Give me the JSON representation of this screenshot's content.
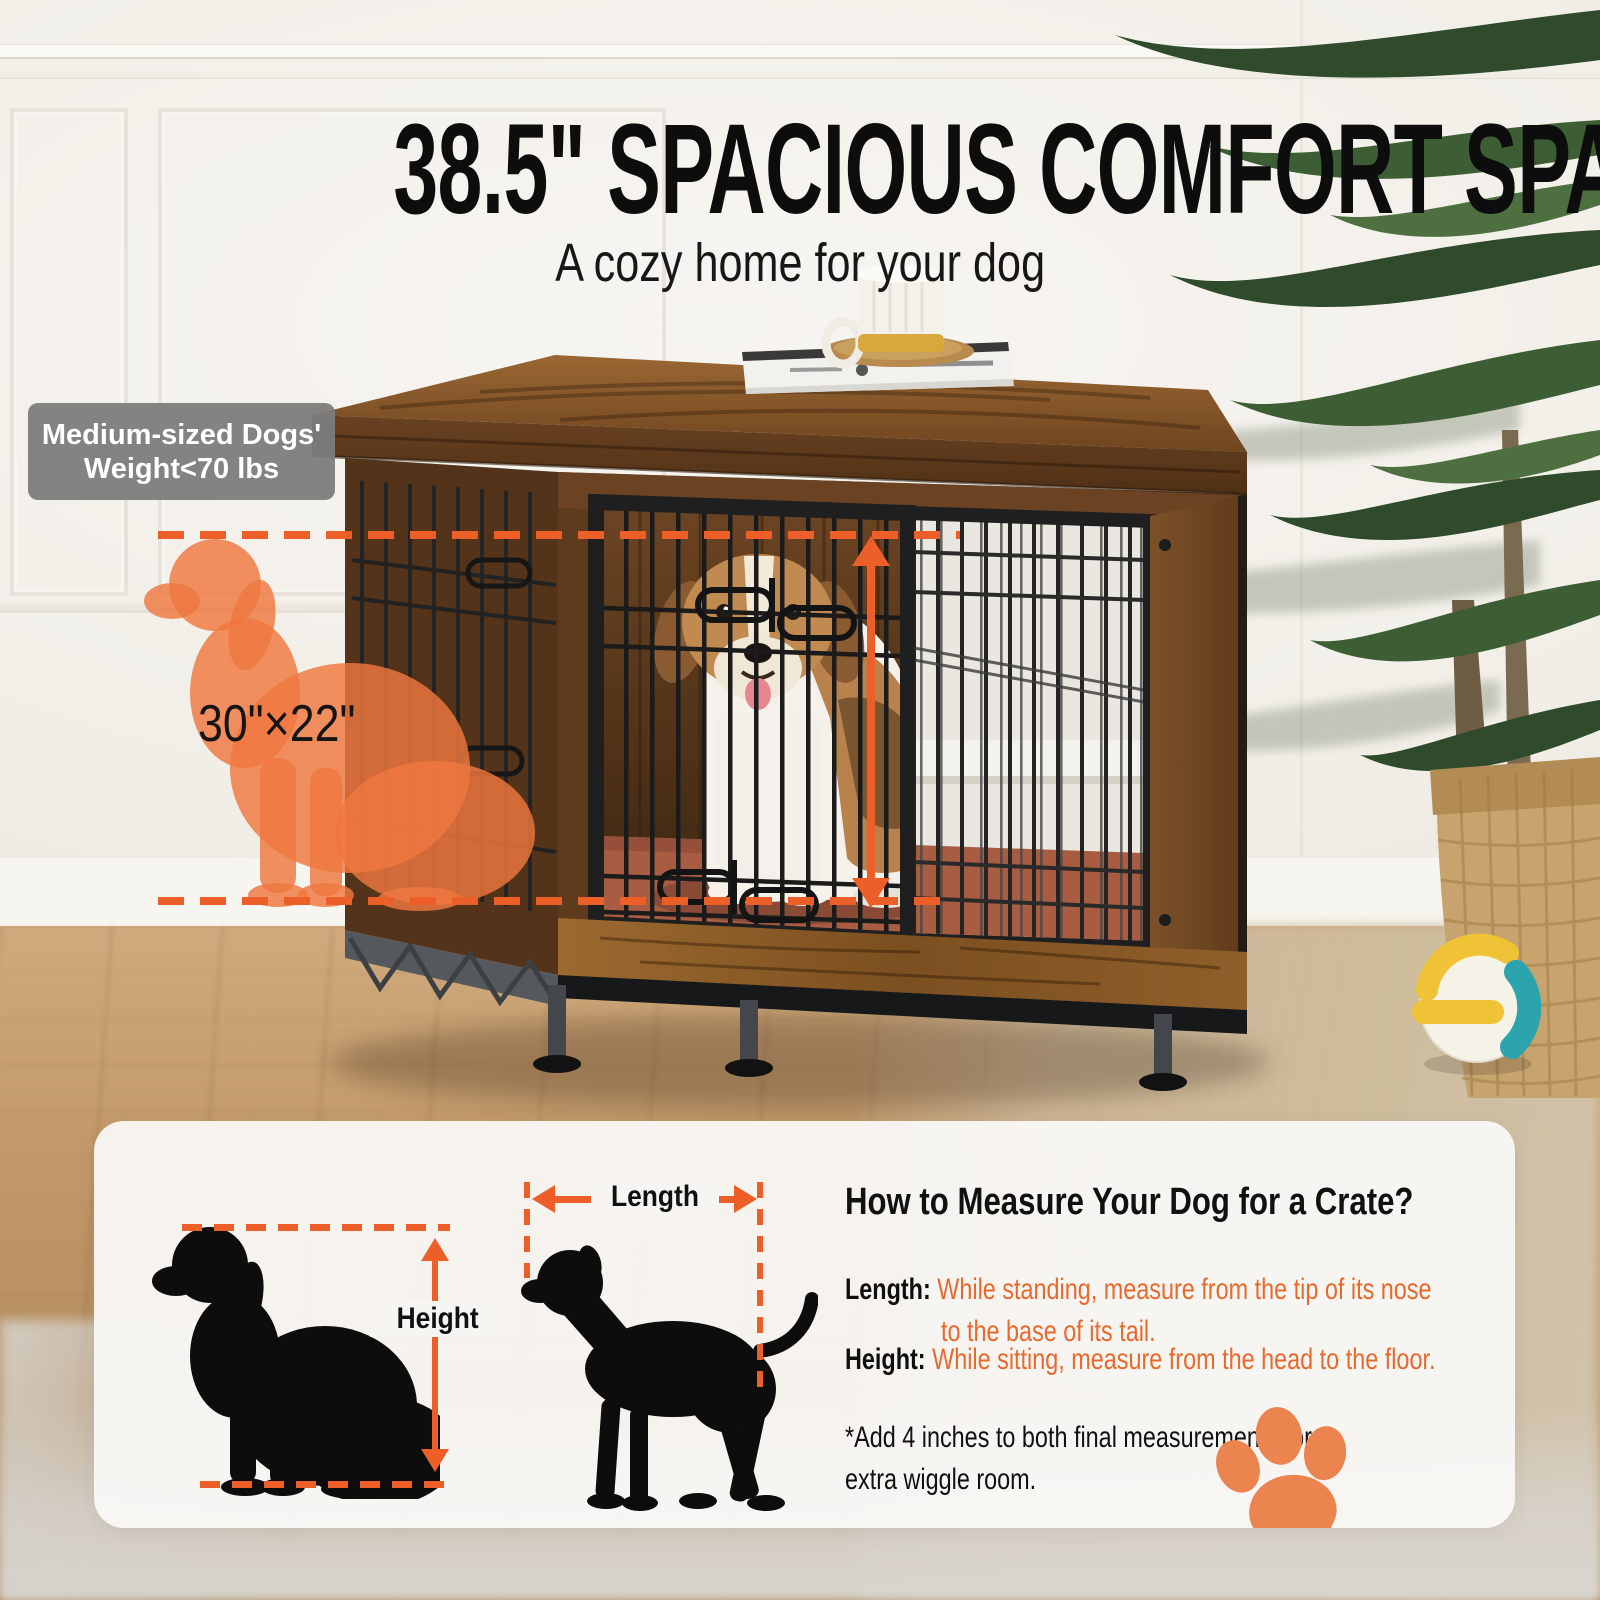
{
  "title": "38.5\" SPACIOUS COMFORT SPACE",
  "subtitle": "A cozy home for your dog",
  "badge": {
    "line1": "Medium-sized Dogs'",
    "line2": "Weight<70 lbs"
  },
  "crate": {
    "inner_size_label": "30\"×22\""
  },
  "measure_card": {
    "heading": "How to Measure Your Dog for a Crate?",
    "height_arrow_label": "Height",
    "length_arrow_label": "Length",
    "length_label": "Length:",
    "length_text_line1": "While standing, measure from the tip of its nose",
    "length_text_line2": "to the base of its tail.",
    "height_label": "Height:",
    "height_text": "While sitting, measure from the head to the floor.",
    "note_line1": "*Add 4 inches to both final measurements for",
    "note_line2": "extra wiggle room."
  },
  "colors": {
    "accent_orange": "#ED5F28",
    "silhouette_orange": "#EF7840",
    "paw_orange": "#EC8450",
    "badge_gray": "#7C7C7C"
  }
}
